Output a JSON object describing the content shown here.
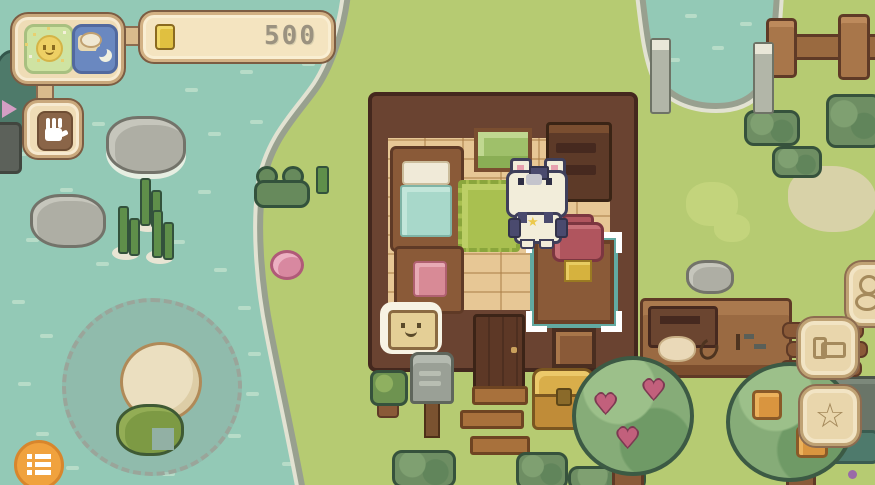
{
  "hud": {
    "status_panel": {
      "day_icon": "happy-sun",
      "night_icon": "sleeping-cat-with-moon"
    },
    "hand_button": {
      "icon": "hand"
    },
    "currency_bar": {
      "icon": "gold-coin",
      "value": "500"
    },
    "menu_button": {
      "icon": "bullet-list"
    },
    "side_buttons": [
      {
        "id": "critter-button",
        "icon": "critter",
        "glyph": ""
      },
      {
        "id": "furniture-button",
        "icon": "bed",
        "glyph": ""
      },
      {
        "id": "star-button",
        "icon": "star-outline",
        "glyph": "☆"
      }
    ]
  },
  "world": {
    "heart_fruit_glyph": "♥",
    "cat_star_glyph": "★"
  },
  "colors": {
    "water": "#93c9b6",
    "grass": "#b6cb72",
    "ui_cream": "#efdcb6",
    "ui_border": "#c9a87c",
    "ui_outline": "#8d6c50",
    "accent_orange": "#f0a23e",
    "selection_teal": "#62aaa2",
    "heart_pink": "#c2607c",
    "coin_gold": "#e0c040",
    "house_wall": "#6a4331",
    "floor_tan": "#e7c795"
  }
}
